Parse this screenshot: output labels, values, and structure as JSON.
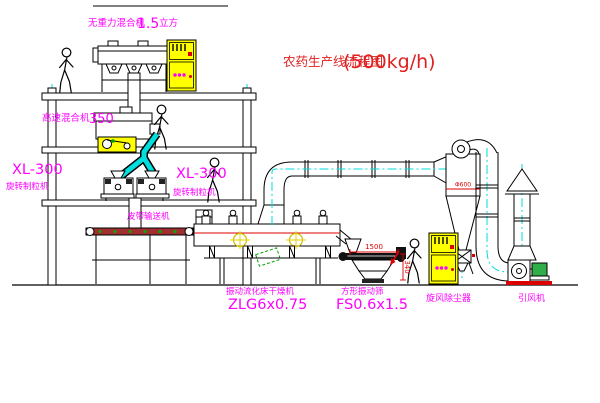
{
  "diagram": {
    "title": {
      "text": "农药生产线流程图",
      "capacity": "(500kg/h)"
    },
    "equipment": {
      "gravity_mixer": {
        "name": "无重力混合机",
        "size": "1.5",
        "unit": "立方"
      },
      "high_speed_mixer": {
        "name": "高速混合机",
        "size": "350"
      },
      "granulator_left": {
        "model": "XL-300",
        "name": "旋转制粒机"
      },
      "granulator_mid": {
        "model": "XL-300",
        "name": "旋转制粒机"
      },
      "belt_conveyor": {
        "name": "皮带输送机"
      },
      "fluid_bed_dryer": {
        "name": "振动流化床干燥机",
        "model": "ZLG6x0.75"
      },
      "square_sieve": {
        "name": "方形振动筛",
        "model": "FS0.6x1.5"
      },
      "cyclone": {
        "name": "旋风除尘器"
      },
      "fan": {
        "name": "引风机"
      }
    },
    "dimensions": {
      "sieve_length": "1500",
      "sieve_height": "340",
      "cyclone_note": "Φ600"
    },
    "colors": {
      "label": "#ff00ff",
      "title": "#e02020",
      "dimension": "#dd0000",
      "centerline": "#00dede",
      "highlight": "#ffff00"
    }
  }
}
